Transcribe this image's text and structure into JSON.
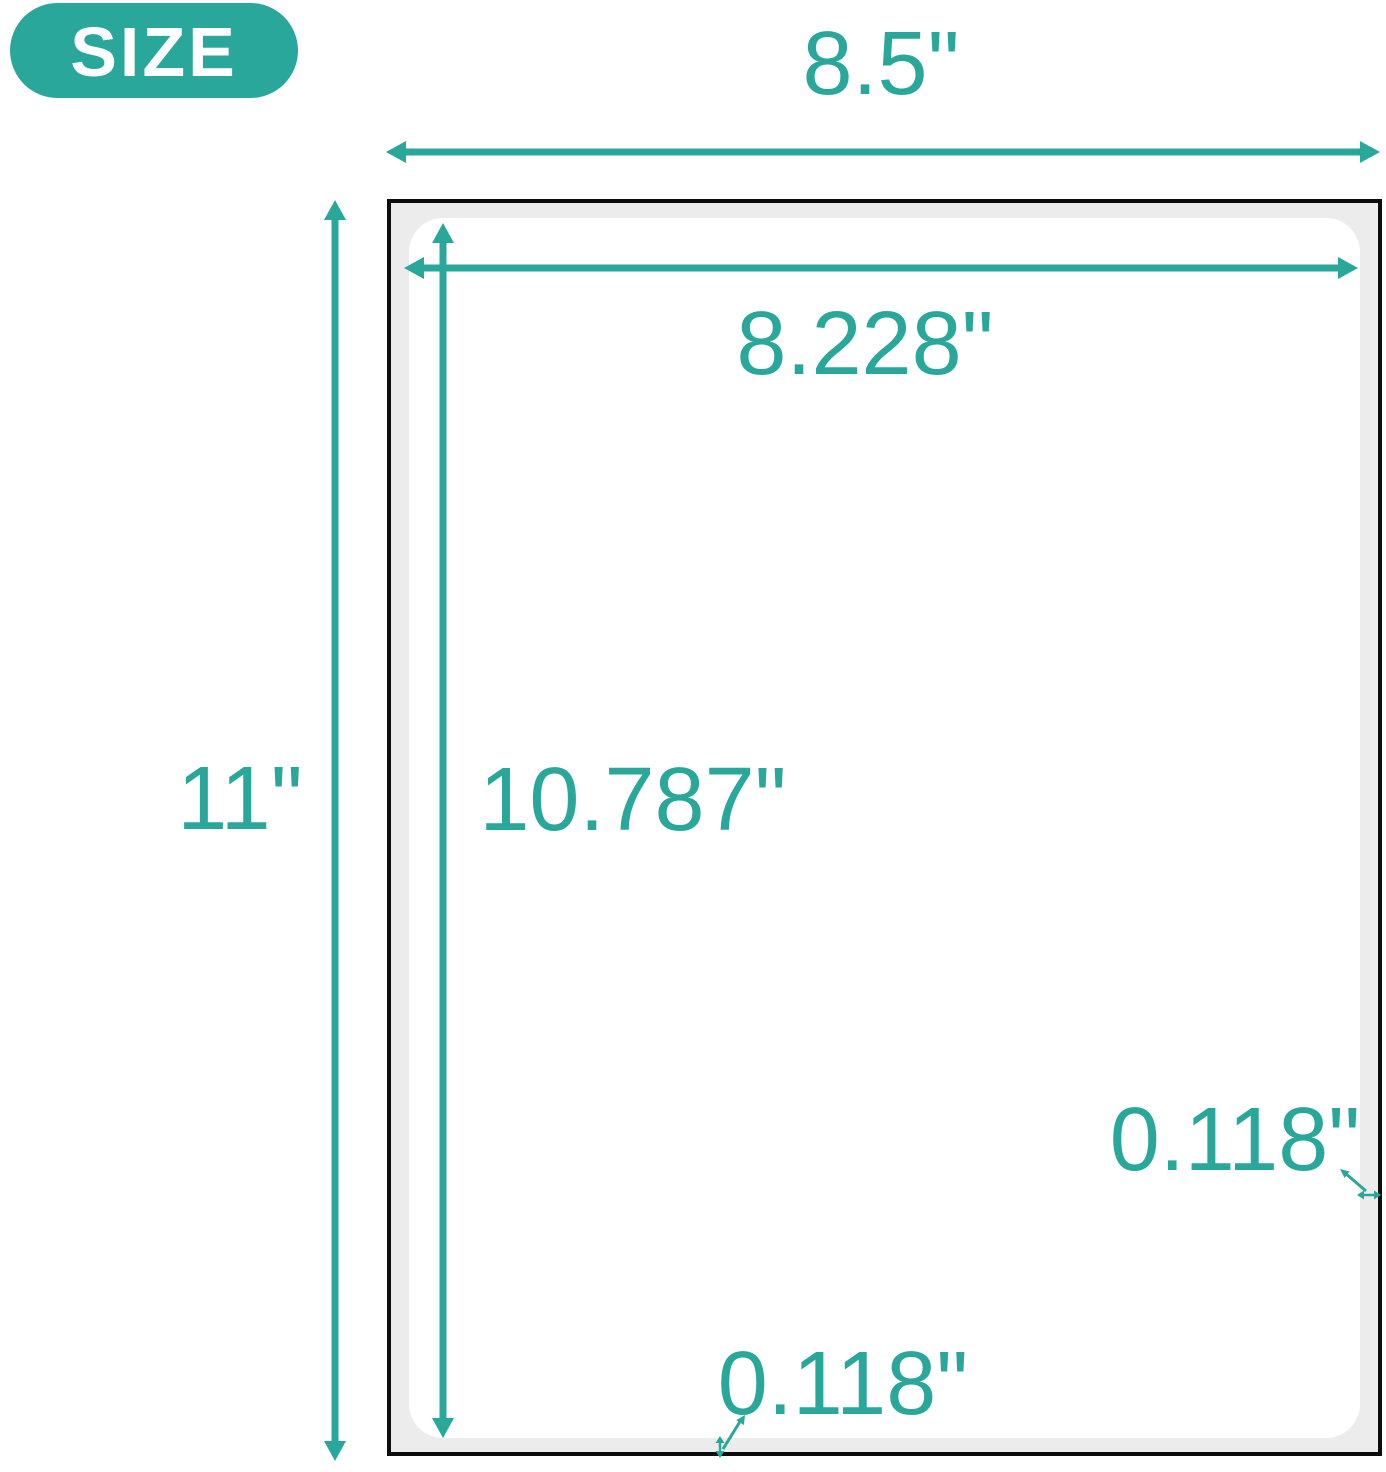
{
  "colors": {
    "accent": "#2AA79B",
    "sheet_background": "#ECECEC",
    "sheet_border": "#0D0D0D",
    "label_background": "#FFFFFF"
  },
  "badge": {
    "label": "SIZE"
  },
  "dimensions": {
    "sheet_width": "8.5\"",
    "sheet_height": "11\"",
    "label_width": "8.228\"",
    "label_height": "10.787\"",
    "bottom_margin": "0.118\"",
    "right_margin": "0.118\""
  }
}
